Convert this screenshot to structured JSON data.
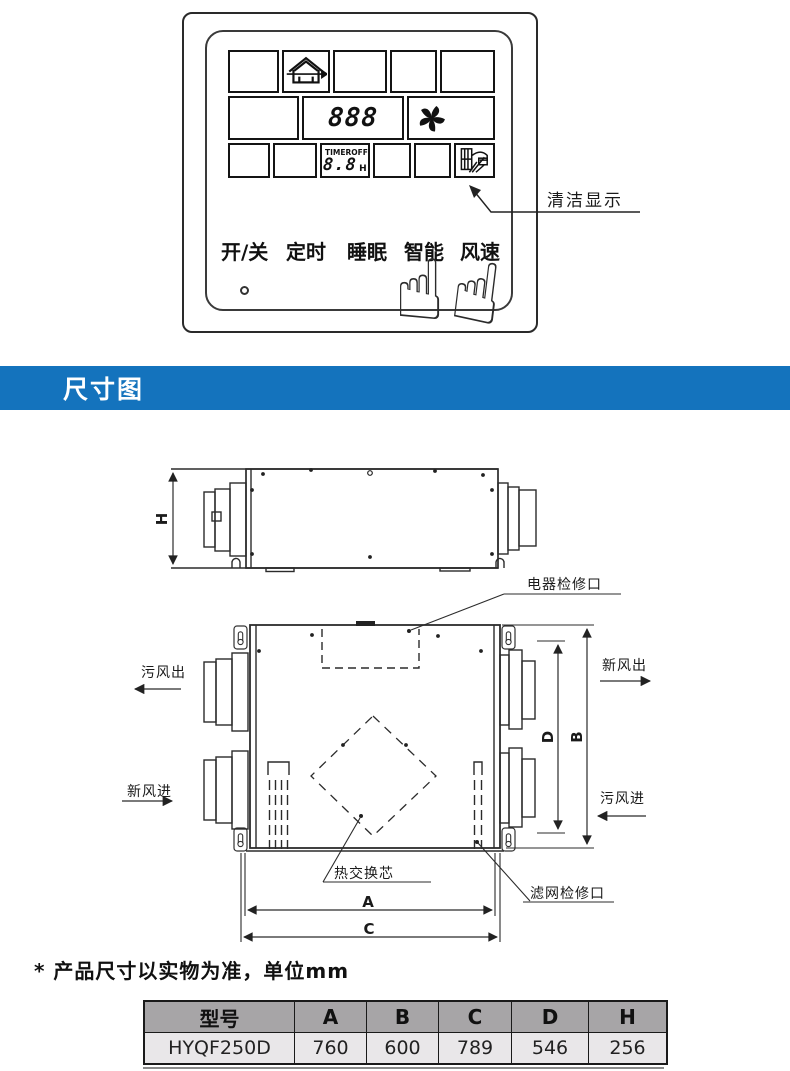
{
  "remote_panel": {
    "display": {
      "mode_value": "888",
      "timer_label": "TIMER",
      "timer_state": "OFF",
      "timer_value": "8.8",
      "timer_unit": "H",
      "icons": {
        "ventilation": "house-ventilation-icon",
        "fan": "fan-icon",
        "clean": "clean-filter-icon"
      }
    },
    "buttons": [
      "开/关",
      "定时",
      "睡眠",
      "智能",
      "风速"
    ],
    "annotation": "清洁显示"
  },
  "section_banner": {
    "title": "尺寸图",
    "background": "#1473bd"
  },
  "drawing": {
    "labels": {
      "electrical_access": "电器检修口",
      "exhaust_air_out": "污风出",
      "fresh_air_out": "新风出",
      "fresh_air_in": "新风进",
      "exhaust_air_in": "污风进",
      "heat_exchange_core": "热交换芯",
      "filter_access": "滤网检修口"
    },
    "dims": {
      "h": "H",
      "a": "A",
      "b": "B",
      "c": "C",
      "d": "D"
    }
  },
  "note": "* 产品尺寸以实物为准，单位mm",
  "spec_table": {
    "headers": [
      "型号",
      "A",
      "B",
      "C",
      "D",
      "H"
    ],
    "rows": [
      [
        "HYQF250D",
        "760",
        "600",
        "789",
        "546",
        "256"
      ]
    ],
    "header_bg": "#a7a5a7",
    "row_bg": "#e9e7e9"
  }
}
